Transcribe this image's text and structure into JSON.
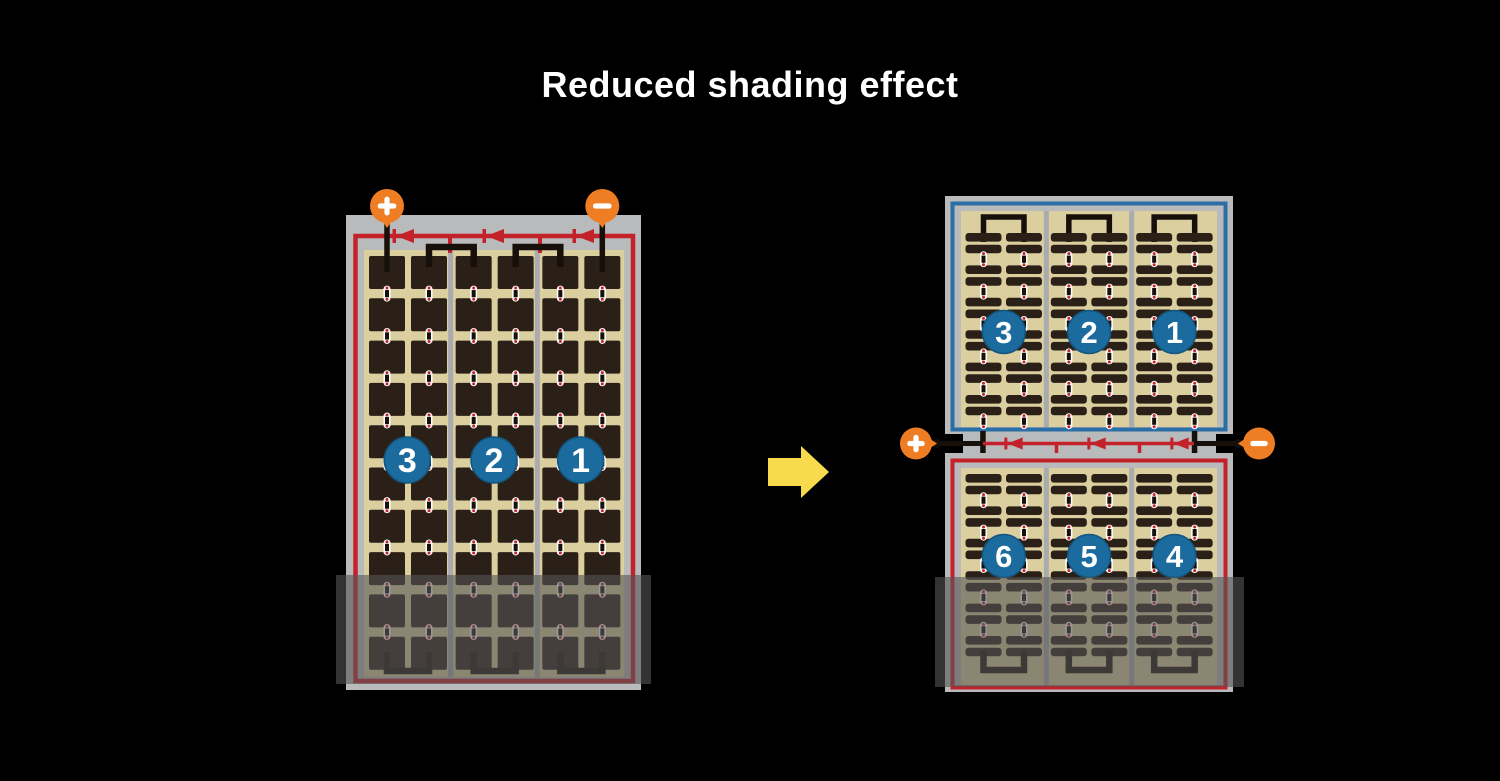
{
  "title": "Reduced shading effect",
  "colors": {
    "background": "#000000",
    "title_text": "#ffffff",
    "frame_gray": "#b9babc",
    "divider_gray": "#a9abae",
    "panel_tan": "#dccf9f",
    "cell_dark": "#2b2017",
    "wire_black": "#170f09",
    "circuit_red": "#c3222a",
    "border_blue": "#2b6ea5",
    "badge_blue": "#1b6b9e",
    "badge_rim": "#12557f",
    "badge_text": "#ffffff",
    "terminal_orange": "#ef7d23",
    "terminal_glyph": "#ffffff",
    "arrow_yellow": "#f8db4d",
    "connector_white": "#ffffff",
    "connector_red": "#cc2127",
    "shade_overlay": "rgba(85,85,85,0.6)"
  },
  "before_module": {
    "terminal_positive": "+",
    "terminal_negative": "−",
    "string_badges": [
      "3",
      "2",
      "1"
    ],
    "cell_columns": 6,
    "cell_rows": 10,
    "bypass_diodes": 3,
    "shaded_bottom": true
  },
  "after_module": {
    "top_half": {
      "string_badges": [
        "3",
        "2",
        "1"
      ]
    },
    "bottom_half": {
      "string_badges": [
        "6",
        "5",
        "4"
      ]
    },
    "terminal_positive": "+",
    "terminal_negative": "−",
    "bypass_diodes": 3,
    "strip_columns": 6,
    "strip_row_blocks": 6,
    "shaded_bottom": true
  }
}
